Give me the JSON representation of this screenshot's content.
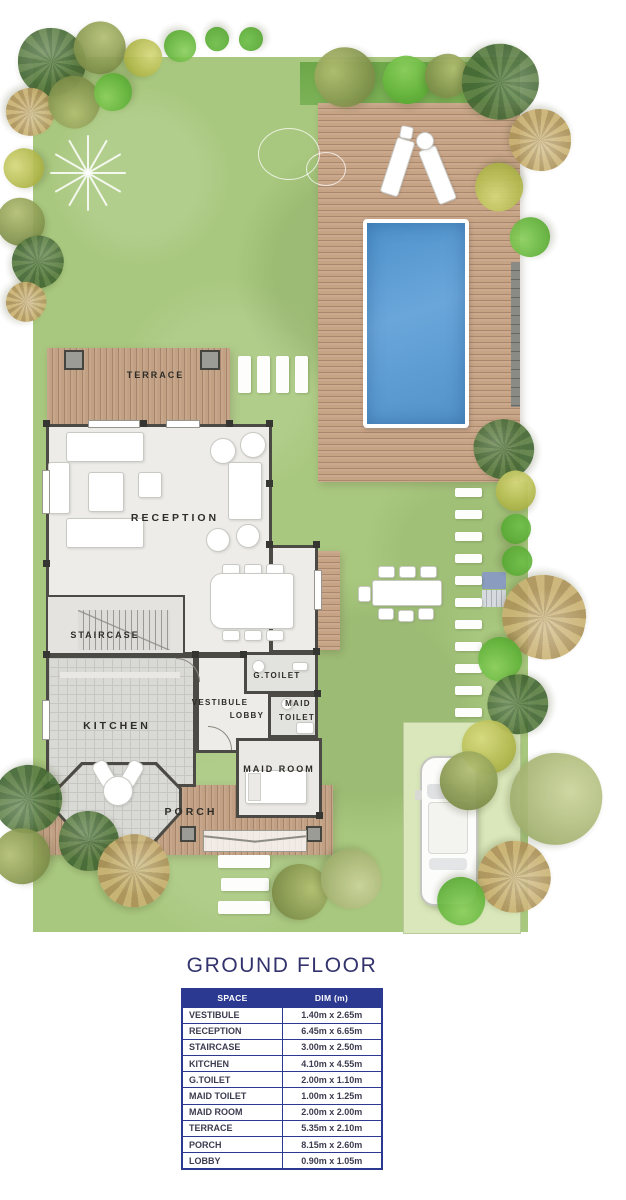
{
  "plan": {
    "room_labels": {
      "terrace": "TERRACE",
      "reception": "RECEPTION",
      "staircase": "STAIRCASE",
      "kitchen": "KITCHEN",
      "vestibule_line1": "VESTIBULE",
      "vestibule_line2": "LOBBY",
      "g_toilet": "G.TOILET",
      "maid_toilet_line1": "MAID",
      "maid_toilet_line2": "TOILET",
      "maid_room": "MAID ROOM",
      "porch": "PORCH"
    },
    "colors": {
      "lawn": "#a9c87f",
      "lawn_dark_band": "#6da74a",
      "parking_pad": "#d9e7ba",
      "deck_wood": "#c7a385",
      "pool_water": "#5b9bd2",
      "room_fill": "#edece8",
      "wall": "#4c4a44"
    }
  },
  "section": {
    "title": "GROUND FLOOR"
  },
  "table": {
    "columns": {
      "space": "SPACE",
      "dim": "DIM (m)"
    },
    "header_bg": "#2b3990",
    "rows": [
      {
        "space": "VESTIBULE",
        "dim": "1.40m x 2.65m"
      },
      {
        "space": "RECEPTION",
        "dim": "6.45m x 6.65m"
      },
      {
        "space": "STAIRCASE",
        "dim": "3.00m x 2.50m"
      },
      {
        "space": "KITCHEN",
        "dim": "4.10m x 4.55m"
      },
      {
        "space": "G.TOILET",
        "dim": "2.00m x 1.10m"
      },
      {
        "space": "MAID TOILET",
        "dim": "1.00m x 1.25m"
      },
      {
        "space": "MAID ROOM",
        "dim": "2.00m x 2.00m"
      },
      {
        "space": "TERRACE",
        "dim": "5.35m x 2.10m"
      },
      {
        "space": "PORCH",
        "dim": "8.15m x 2.60m"
      },
      {
        "space": "LOBBY",
        "dim": "0.90m x 1.05m"
      }
    ]
  }
}
